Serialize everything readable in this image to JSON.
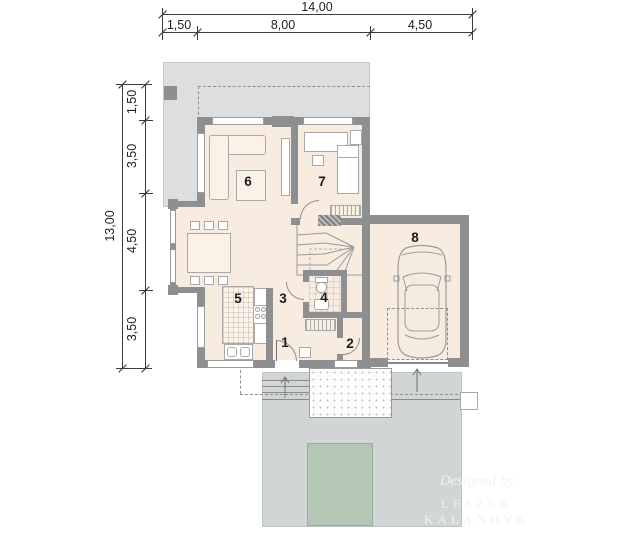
{
  "plan": {
    "type": "floor-plan",
    "storey": "ground floor with garage",
    "rooms": [
      {
        "number": "1",
        "role": "entry"
      },
      {
        "number": "2",
        "role": "wc-storage"
      },
      {
        "number": "3",
        "role": "hall"
      },
      {
        "number": "4",
        "role": "bathroom"
      },
      {
        "number": "5",
        "role": "kitchen"
      },
      {
        "number": "6",
        "role": "living-room"
      },
      {
        "number": "7",
        "role": "bedroom"
      },
      {
        "number": "8",
        "role": "garage"
      }
    ]
  },
  "dims": {
    "top": {
      "total": "14,00",
      "segs": [
        "1,50",
        "8,00",
        "4,50"
      ]
    },
    "left": {
      "total": "13,00",
      "segs": [
        "1,50",
        "3,50",
        "4,50",
        "3,50"
      ]
    }
  },
  "watermark": {
    "line1": "Designed by",
    "line2": "LESZEK KALANDYK"
  },
  "colors": {
    "wall": "#8d8f91",
    "floor": "#f7ecdf",
    "terrace": "#dcdee0",
    "driveway": "#d2d5d6",
    "lawn": "#b4c6b4",
    "dimension_line": "#3c3c3c"
  }
}
